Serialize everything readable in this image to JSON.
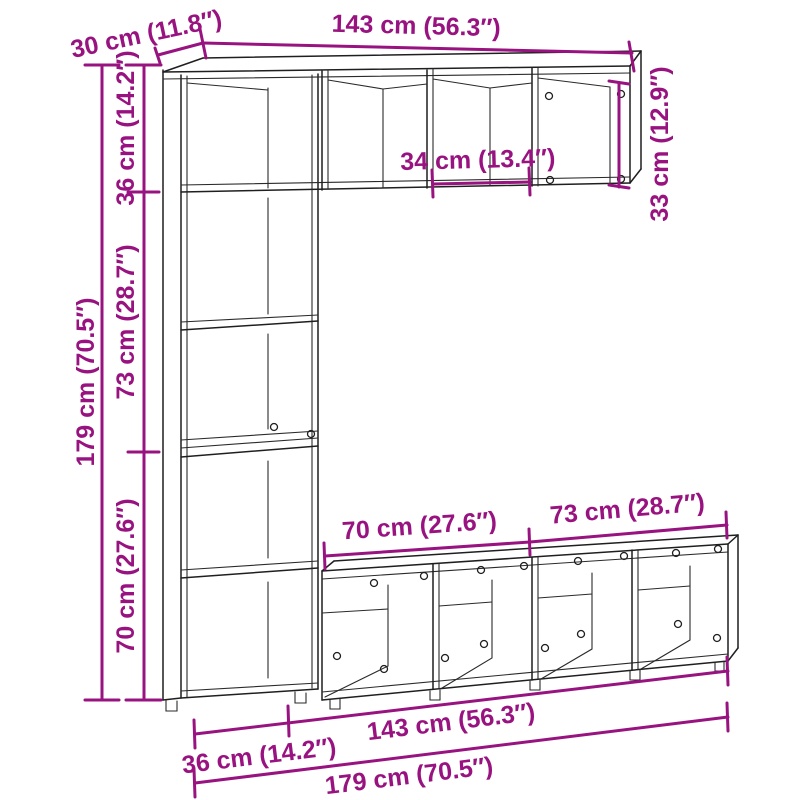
{
  "diagram": {
    "type": "furniture-dimension-diagram",
    "subject": "3-piece bookcase wall unit line drawing",
    "background_color": "#FFFFFF",
    "line_color": "#1F1F1F",
    "accent_color": "#981380",
    "dimensions": {
      "depth": "30 cm (11.8″)",
      "width_top_cabinet": "143 cm (56.3″)",
      "height_top_cabinet": "36 cm (14.2″)",
      "compartment_width": "34 cm (13.4″)",
      "compartment_height": "33 cm (12.9″)",
      "height_total": "179 cm (70.5″)",
      "height_middle_section": "73 cm (28.7″)",
      "height_bottom_section": "70 cm (27.6″)",
      "width_bottom_left_span": "70 cm (27.6″)",
      "width_bottom_right_span": "73 cm (28.7″)",
      "width_tall_bookcase": "36 cm (14.2″)",
      "width_bottom_cabinet": "143 cm (56.3″)",
      "width_total": "179 cm (70.5″)"
    }
  }
}
